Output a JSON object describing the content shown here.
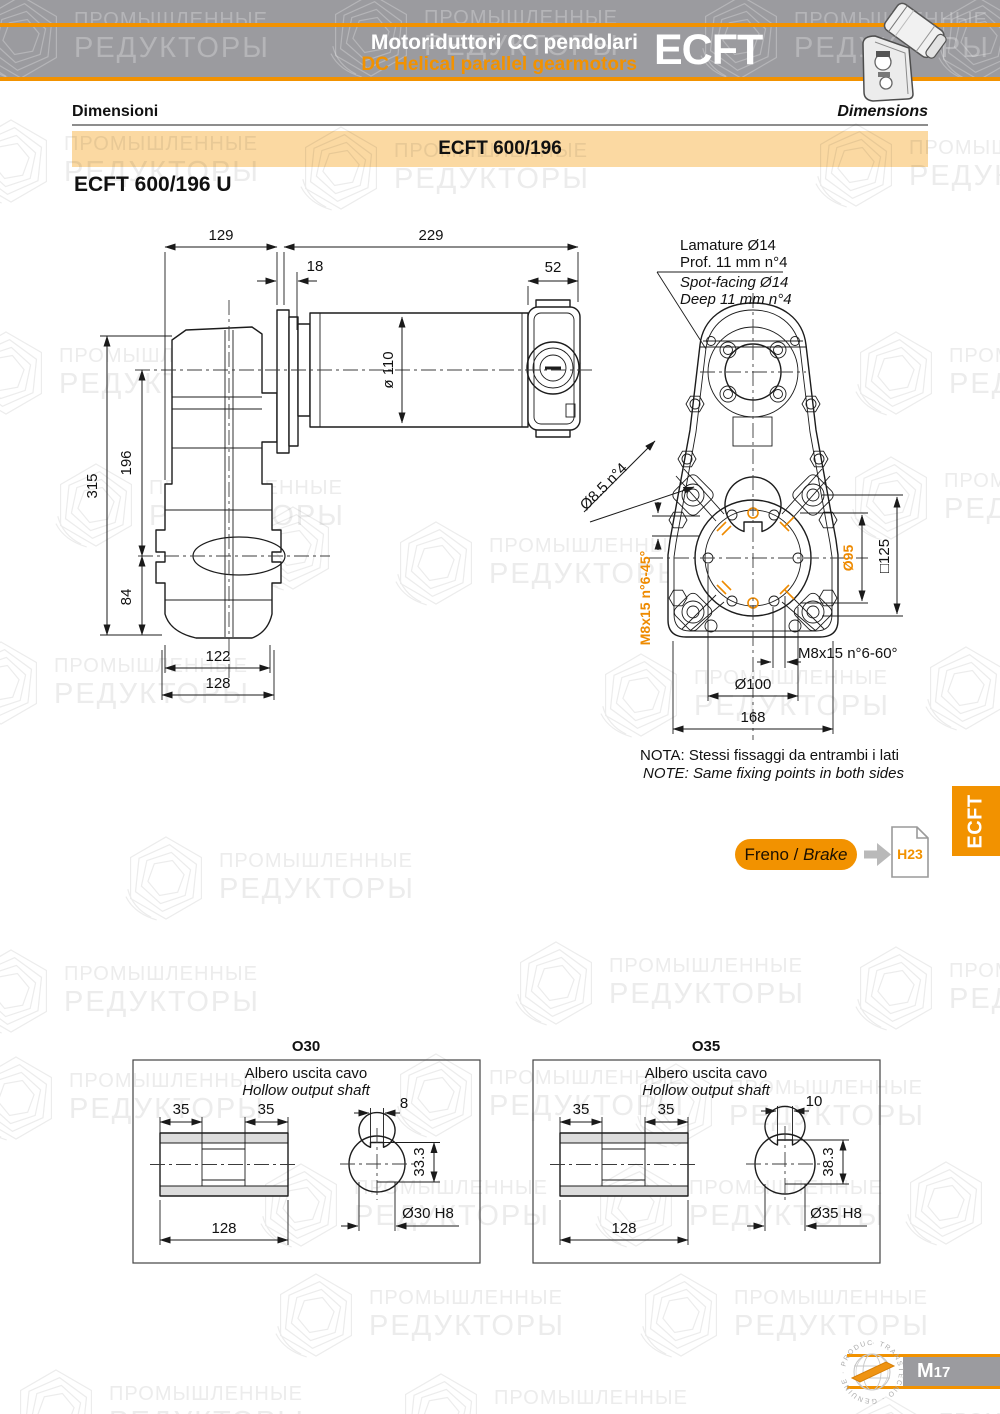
{
  "header": {
    "title_it": "Motoriduttori CC pendolari",
    "title_en": "DC Helical parallel gearmotors",
    "series": "ECFT"
  },
  "section": {
    "label_it": "Dimensioni",
    "label_en": "Dimensions"
  },
  "model_band": {
    "label": "ECFT 600/196"
  },
  "variant_title": {
    "label": "ECFT 600/196 U"
  },
  "side_view": {
    "dims": {
      "width_box": "129",
      "width_motor": "229",
      "flange": "18",
      "endcap": "52",
      "motor_dia": "ø 110",
      "height_total": "315",
      "center_dist": "196",
      "bottom": "84",
      "foot_inner": "122",
      "foot_outer": "128"
    }
  },
  "front_view": {
    "spotface": {
      "line1": "Lamature Ø14",
      "line2": "Prof. 11 mm n°4",
      "line3": "Spot-facing Ø14",
      "line4": "Deep 11 mm n°4"
    },
    "dims": {
      "holes": "Ø8.5 n°4",
      "tap45": "M8x15 n°6-45°",
      "bolt_circle": "Ø95",
      "square": "□125",
      "tap60": "M8x15 n°6-60°",
      "circle100": "Ø100",
      "width": "168"
    },
    "note_it": "NOTA:  Stessi fissaggi da entrambi i lati",
    "note_en": "NOTE: Same fixing points in both sides"
  },
  "brake": {
    "label_it": "Freno /",
    "label_en": "Brake",
    "page_ref": "H23"
  },
  "side_tab": {
    "label": "ECFT"
  },
  "output_shafts": [
    {
      "title": "O30",
      "subtitle_it": "Albero uscita cavo",
      "subtitle_en": "Hollow output shaft",
      "dims": {
        "hub_left": "35",
        "hub_right": "35",
        "length": "128",
        "key_width": "8",
        "key_depth": "33.3",
        "bore": "Ø30 H8"
      }
    },
    {
      "title": "O35",
      "subtitle_it": "Albero uscita cavo",
      "subtitle_en": "Hollow output shaft",
      "dims": {
        "hub_left": "35",
        "hub_right": "35",
        "length": "128",
        "key_width": "10",
        "key_depth": "38.3",
        "bore": "Ø35 H8"
      }
    }
  ],
  "footer": {
    "page_letter": "M",
    "page_number": "17",
    "stamp_text": "· TRANSTECNO · GENUINE · PRODUCTS"
  },
  "watermark": {
    "line1": "ПРОМЫШЛЕННЫЕ",
    "line2": "РЕДУКТОРЫ"
  },
  "colors": {
    "orange": "#F29200",
    "light_orange": "#FBD9A2",
    "header_gray": "#9B9B9F",
    "dim_orange": "#EE8A00"
  }
}
